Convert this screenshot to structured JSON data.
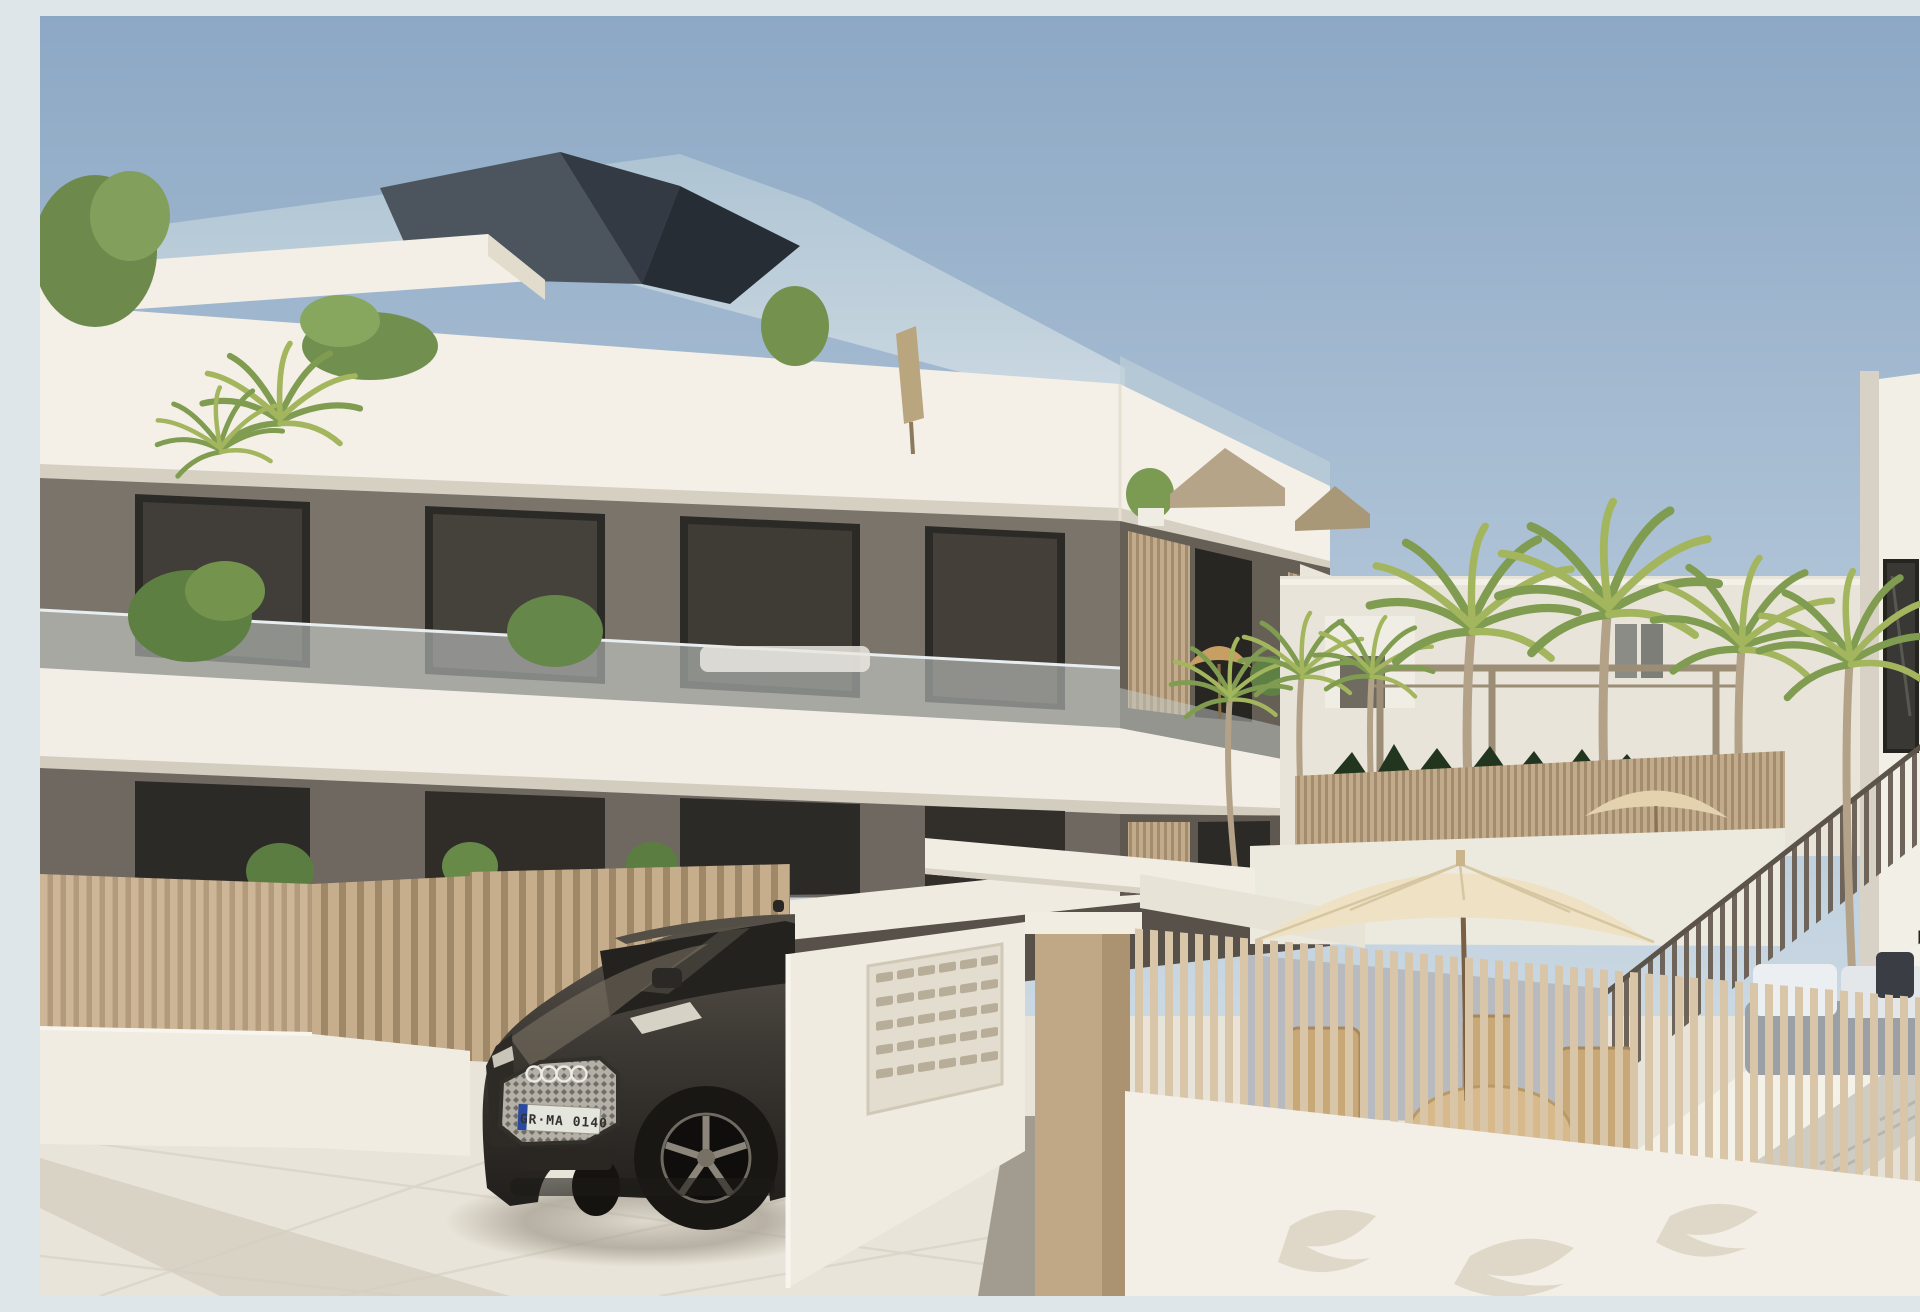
{
  "scene": {
    "description": "3D architectural rendering: modern three-storey apartment block with white cantilevered terrace bands, taupe walls, glass balustrades and wooden slat dividers; beige slat fences, entrance with mailbox wall and pillar, palm-tree pool courtyard, side building with staircase, cream patio umbrella with rattan dining set, and a dark Audi SUV parked on pale pavement",
    "sky": {
      "top_color": "#8da8c5",
      "horizon_color": "#dde7eb"
    },
    "main_building": {
      "label": "apartment-block",
      "storeys": 3,
      "band_color": "#f4f0e7",
      "band_shadow_color": "#d6d0c2",
      "wall_color": "#7b746b",
      "wall_shade_color": "#57514a",
      "window_color": "#2c2a26",
      "roof_color": "#424952",
      "roof_glass_color": "#b7cbd8",
      "balustrade_color": "#cdd4d2"
    },
    "right_building": {
      "label": "side-building",
      "wall_color": "#f2efe7",
      "shade_color": "#d8d2c6",
      "window_color": "#3a3834"
    },
    "entrance": {
      "mailbox_rows": 5,
      "mailbox_cols": 6,
      "mailbox_panel_color": "#e3ddcf",
      "wall_color": "#efebe1",
      "pillar_color": "#c0a887",
      "beam_color": "#f1ede3"
    },
    "fences": {
      "slat_color": "#c9b294",
      "slat_gap_color": "#a8906f",
      "base_wall_color": "#f0ece2"
    },
    "vegetation": {
      "palm_trees": 7,
      "hedge_color": "#22361f",
      "frond_colors": [
        "#7f9c50",
        "#a3b65e",
        "#b0bd62"
      ],
      "trunk_color": "#b3a288"
    },
    "furniture": {
      "umbrella_color": "#eee1c4",
      "balcony_parasol_color": "#c89f63",
      "pool_parasol_color": "#e3d2ad",
      "table_color": "#d7b98b",
      "chair_color": "#c9a877",
      "sofa_base_color": "#9aa0a6",
      "sofa_cushion_color": "#eceff1",
      "deck_color": "#b7bbc0"
    },
    "car": {
      "label": "dark-audi-suv",
      "body_color": "#3c3833",
      "glass_color": "#24221f",
      "wheel_color": "#191713",
      "grille_color": "#b9b4ac",
      "rings_color": "#ecebe6",
      "license_plate": "GR·MA 0140",
      "plate_band_color": "#2a4aa0"
    },
    "ground": {
      "pavement_color": "#e9e4d9",
      "walkway_color": "#d9d3c6",
      "shadow_color": "#a69f92"
    }
  }
}
